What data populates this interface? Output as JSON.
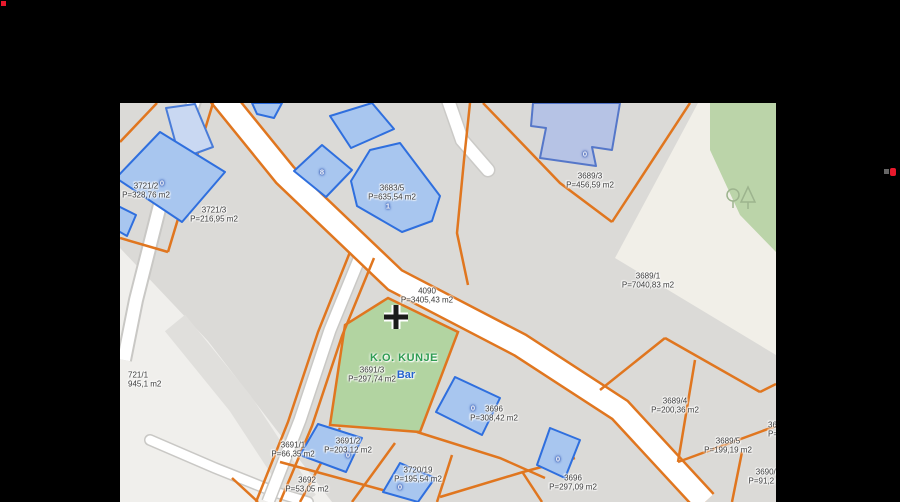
{
  "window": {
    "background": "#000000",
    "markers": {
      "top_left_red": "#E8192C",
      "right_red": "#E8192C",
      "right_gray": "#666666"
    }
  },
  "map": {
    "district_label": "K.O. KUNJE",
    "place_label": "Bar",
    "parcels": [
      {
        "name": "3721/2",
        "area": "P=328,76 m2"
      },
      {
        "name": "3721/3",
        "area": "P=216,95 m2"
      },
      {
        "name": "3683/5",
        "area": "P=635,54 m2"
      },
      {
        "name": "3689/3",
        "area": "P=456,59 m2"
      },
      {
        "name": "3689/1",
        "area": "P=7040,83 m2"
      },
      {
        "name": "4090",
        "area": "P=3405,43 m2"
      },
      {
        "name": "3691/3",
        "area": "P=297,74 m2"
      },
      {
        "name": "721/1",
        "area": "945,1 m2"
      },
      {
        "name": "3696",
        "area": "P=308,42 m2"
      },
      {
        "name": "3689/4",
        "area": "P=200,36 m2"
      },
      {
        "name": "3689/5",
        "area": "P=199,19 m2"
      },
      {
        "name": "3690/2",
        "area": "P=91,2 m2"
      },
      {
        "name": "3691/1",
        "area": "P=66,35 m2"
      },
      {
        "name": "3691/2",
        "area": "P=203,12 m2"
      },
      {
        "name": "3692",
        "area": "P=53,05 m2"
      },
      {
        "name": "3720/19",
        "area": "P=195,54 m2"
      },
      {
        "name": "3696",
        "area": "P=297,09 m2"
      },
      {
        "name": "36",
        "area": "P="
      }
    ],
    "building_numbers": [
      "0",
      "8",
      "1",
      "0",
      "0",
      "0",
      "0",
      "0"
    ],
    "colors": {
      "parcel_line_orange": "#E0761F",
      "building_fill_blue": "#A8C6EF",
      "building_border_blue": "#2F6FDE",
      "vegetation_green": "#BBD4A9",
      "parcel_green": "#B2D4A1",
      "road_white": "#FFFFFF",
      "base_gray": "#DBDAD7",
      "light_area": "#F1EFE8",
      "district_text": "#2F9C52",
      "place_text": "#2563CE"
    }
  }
}
